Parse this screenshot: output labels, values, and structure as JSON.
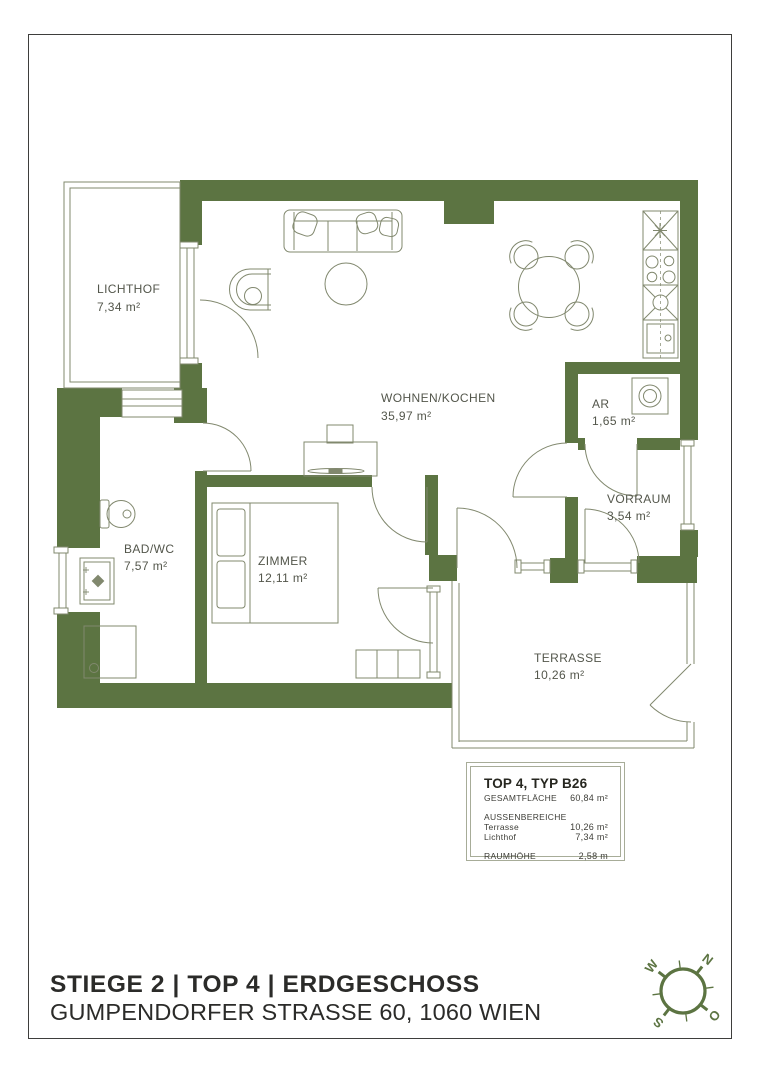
{
  "page": {
    "background": "#ffffff",
    "border_color": "#3e3e3c"
  },
  "plan": {
    "wall_color": "#5c7442",
    "line_color": "#81886e",
    "label_color": "#53564b",
    "rooms": [
      {
        "id": "lichthof",
        "name": "LICHTHOF",
        "area": "7,34 m²"
      },
      {
        "id": "wohnen-kochen",
        "name": "WOHNEN/KOCHEN",
        "area": "35,97 m²"
      },
      {
        "id": "ar",
        "name": "AR",
        "area": "1,65 m²"
      },
      {
        "id": "vorraum",
        "name": "VORRAUM",
        "area": "3,54 m²"
      },
      {
        "id": "bad-wc",
        "name": "BAD/WC",
        "area": "7,57 m²"
      },
      {
        "id": "zimmer",
        "name": "ZIMMER",
        "area": "12,11 m²"
      },
      {
        "id": "terrasse",
        "name": "TERRASSE",
        "area": "10,26 m²"
      }
    ]
  },
  "info_box": {
    "title": "TOP 4, TYP B26",
    "total": {
      "label": "GESAMTFLÄCHE",
      "value": "60,84 m²"
    },
    "outdoor_section_label": "AUSSENBEREICHE",
    "outdoor_rows": [
      {
        "label": "Terrasse",
        "value": "10,26 m²"
      },
      {
        "label": "Lichthof",
        "value": "7,34 m²"
      }
    ],
    "room_height": {
      "label": "RAUMHÖHE",
      "value": "2,58 m"
    }
  },
  "footer": {
    "line1": "STIEGE 2 | TOP 4 | ERDGESCHOSS",
    "line2": "GUMPENDORFER STRASSE 60, 1060 WIEN"
  },
  "compass": {
    "color": "#5c7442",
    "letters": {
      "n": "N",
      "e": "O",
      "s": "S",
      "w": "W"
    }
  }
}
